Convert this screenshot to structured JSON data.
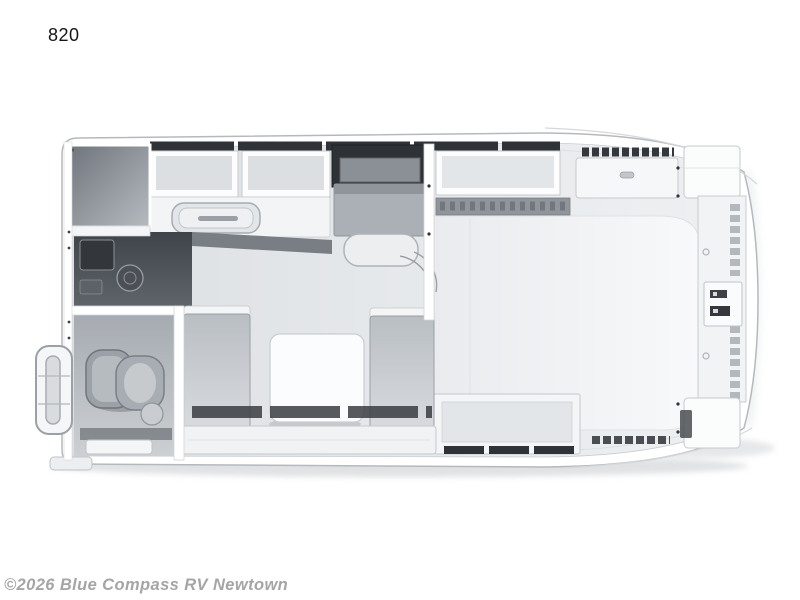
{
  "page": {
    "background_color": "#ffffff"
  },
  "floorplan_label": {
    "text": "820"
  },
  "watermark": {
    "text": "©2026 Blue Compass RV Newtown",
    "color": "#a5a5a5"
  },
  "floorplan": {
    "type": "rv-floorplan-top-down-3d-render",
    "orientation": "entry-door-left, cabover-bed-right",
    "regions": [
      "wardrobe-closet",
      "kitchen-overhead-cabinets",
      "refrigerator",
      "kitchen-sink",
      "range-cooktop-console",
      "galley-counter",
      "bathroom",
      "toilet",
      "shower-pan",
      "entry-grab-handle",
      "dinette-table",
      "dinette-bench-left",
      "dinette-bench-right",
      "under-dinette-storage",
      "cabover-bed",
      "bed-head-shelf",
      "front-storage-shelf",
      "front-wardrobe-column",
      "power-outlets",
      "corner-cabinet-top-right",
      "corner-cabinet-bottom-right",
      "under-bed-storage-bench"
    ]
  },
  "colors": {
    "hull_outline": "#b5b9be",
    "floor": "#e2e5e8",
    "dark_cabinet_slats": "#2f3338",
    "appliance_dark": "#4a4e53",
    "bench_gray": "#c3c7cc",
    "bed_surface": "#f5f6f8",
    "shadow": "#c2c5c8"
  }
}
